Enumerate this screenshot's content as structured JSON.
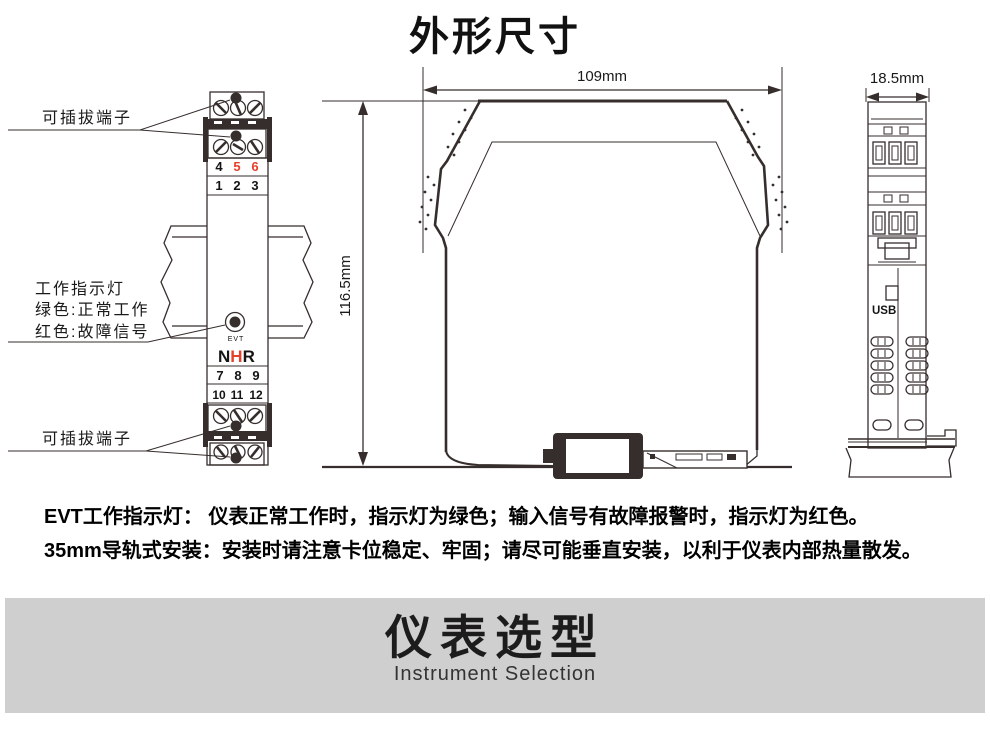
{
  "page": {
    "title": "外形尺寸"
  },
  "front_view": {
    "plug_label_top": "可插拔端子",
    "plug_label_bottom": "可插拔端子",
    "indicator_lines": [
      "工作指示灯",
      "绿色:正常工作",
      "红色:故障信号"
    ],
    "row_456": [
      "4",
      "5",
      "6"
    ],
    "row_123": [
      "1",
      "2",
      "3"
    ],
    "row_789": [
      "7",
      "8",
      "9"
    ],
    "row_101112": [
      "10",
      "11",
      "12"
    ],
    "evt_label": "EVT",
    "logo": {
      "n": "N",
      "h": "H",
      "r": "R"
    }
  },
  "dimensions": {
    "width": "109mm",
    "height": "116.5mm",
    "depth": "18.5mm"
  },
  "end_view": {
    "usb_label": "USB"
  },
  "notes": [
    "EVT工作指示灯： 仪表正常工作时，指示灯为绿色；输入信号有故障报警时，指示灯为红色。",
    "35mm导轨式安装：安装时请注意卡位稳定、牢固；请尽可能垂直安装，以利于仪表内部热量散发。"
  ],
  "banner": {
    "title": "仪表选型",
    "subtitle": "Instrument Selection"
  },
  "colors": {
    "line": "#362e2c",
    "accent_red": "#e5402a",
    "banner_bg": "#d0cfcf",
    "background": "#ffffff"
  }
}
